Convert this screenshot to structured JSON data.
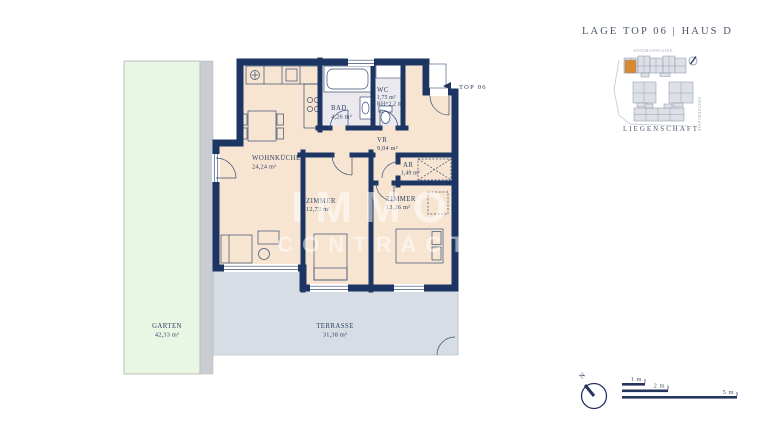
{
  "header": {
    "title": "LAGE TOP 06 | HAUS D"
  },
  "floor_plan": {
    "marker_label": "TOP 06",
    "rooms": {
      "wohnkueche": {
        "name": "WOHNKÜCHE",
        "area": "24,24 m²"
      },
      "bad": {
        "name": "BAD",
        "area": "4,26 m²"
      },
      "wc": {
        "name": "WC",
        "area": "1,75 m²",
        "note": "RH=2,2 m"
      },
      "vr": {
        "name": "VR",
        "area": "9,04 m²"
      },
      "ar": {
        "name": "AR",
        "area": "1,49 m²"
      },
      "zimmer1": {
        "name": "ZIMMER",
        "area": "12,73 m²"
      },
      "zimmer2": {
        "name": "ZIMMER",
        "area": "13,26 m²"
      },
      "garten": {
        "name": "GARTEN",
        "area": "42,33 m²"
      },
      "terrasse": {
        "name": "TERRASSE",
        "area": "31,38 m²"
      }
    }
  },
  "site_plan": {
    "caption": "LIEGENSCHAFT",
    "street_top": "ENDEMANNGASSE",
    "street_right": "GASTGEBGASSE"
  },
  "watermark": {
    "line1": "IMMO",
    "line2": "CONTRACT"
  },
  "scale_bar": {
    "labels": [
      "1 m",
      "2 m",
      "5 m"
    ]
  },
  "compass": {
    "north": "N"
  },
  "colors": {
    "wall": "#1d3563",
    "floor": "#f7e5d1",
    "wet_floor": "#ebe9ed",
    "terrace": "#d7dde5",
    "garden": "#e9f6e3",
    "highlight": "#d98a2e"
  }
}
